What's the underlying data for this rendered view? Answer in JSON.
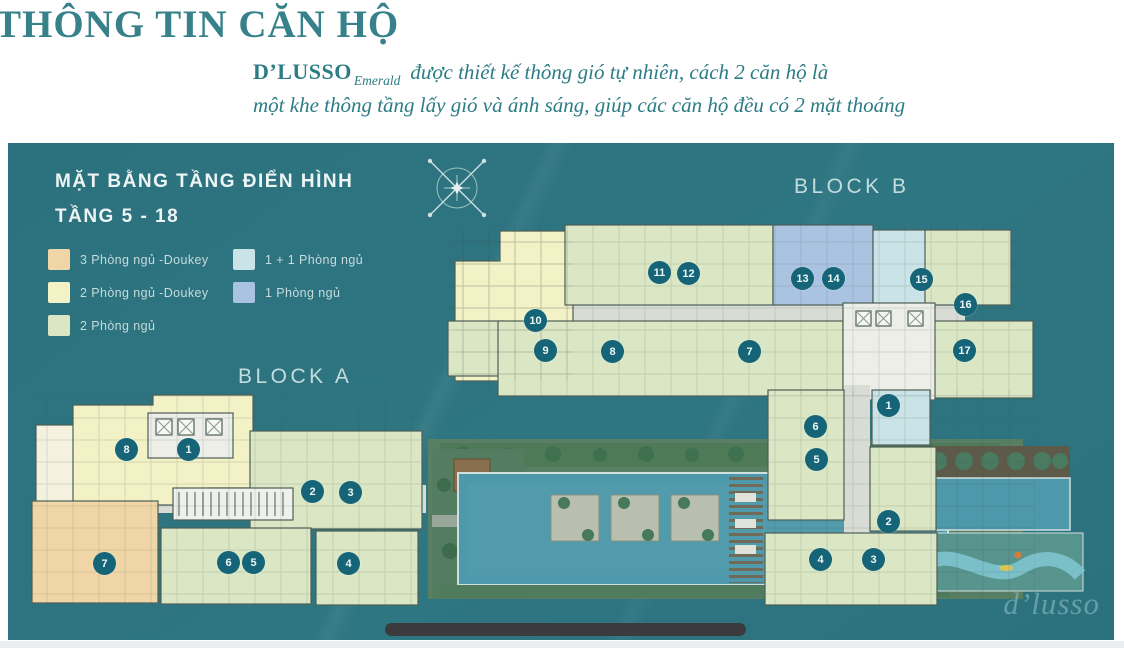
{
  "page": {
    "title": "THÔNG TIN CĂN HỘ",
    "intro": {
      "brand": "D’LUSSO",
      "brand_sub": "Emerald",
      "line1_rest": "được thiết kế thông gió tự nhiên, cách 2 căn hộ là",
      "line2": "một khe thông tầng lấy gió và ánh sáng, giúp các căn hộ đều có 2 mặt thoáng"
    },
    "colors": {
      "title": "#37818a",
      "intro_text": "#2c7c85"
    }
  },
  "panel": {
    "heading": "MẶT BẰNG TẦNG ĐIỂN HÌNH",
    "subheading": "TẦNG 5 - 18",
    "background": "#2d7380",
    "badge_color": "#166477",
    "watermark": "d’lusso",
    "compass_icon": "compass-rose-icon",
    "legend": {
      "items": [
        {
          "label": "3 Phòng ngủ -Doukey",
          "color": "#f0d6a7"
        },
        {
          "label": "2 Phòng ngủ -Doukey",
          "color": "#f3f1c6"
        },
        {
          "label": "2 Phòng ngủ",
          "color": "#dbe7c4"
        },
        {
          "label": "1 + 1 Phòng ngủ",
          "color": "#c9e3e6"
        },
        {
          "label": "1 Phòng ngủ",
          "color": "#aac3e1"
        }
      ]
    },
    "blocks": [
      {
        "label": "BLOCK A"
      },
      {
        "label": "BLOCK B"
      }
    ],
    "units": {
      "block_a": [
        {
          "no": "8",
          "type": 1,
          "x": 118,
          "y": 306
        },
        {
          "no": "1",
          "type": 1,
          "x": 180,
          "y": 306
        },
        {
          "no": "2",
          "type": 2,
          "x": 304,
          "y": 348
        },
        {
          "no": "3",
          "type": 2,
          "x": 342,
          "y": 349
        },
        {
          "no": "7",
          "type": 0,
          "x": 96,
          "y": 420
        },
        {
          "no": "6",
          "type": 2,
          "x": 220,
          "y": 419
        },
        {
          "no": "5",
          "type": 2,
          "x": 245,
          "y": 419
        },
        {
          "no": "4",
          "type": 2,
          "x": 340,
          "y": 420
        }
      ],
      "block_b": [
        {
          "no": "10",
          "type": 1,
          "x": 527,
          "y": 177
        },
        {
          "no": "11",
          "type": 2,
          "x": 651,
          "y": 129
        },
        {
          "no": "12",
          "type": 2,
          "x": 680,
          "y": 130
        },
        {
          "no": "13",
          "type": 4,
          "x": 794,
          "y": 135
        },
        {
          "no": "14",
          "type": 4,
          "x": 825,
          "y": 135
        },
        {
          "no": "15",
          "type": 3,
          "x": 913,
          "y": 136
        },
        {
          "no": "16",
          "type": 2,
          "x": 957,
          "y": 161
        },
        {
          "no": "9",
          "type": 2,
          "x": 537,
          "y": 207
        },
        {
          "no": "8",
          "type": 2,
          "x": 604,
          "y": 208
        },
        {
          "no": "7",
          "type": 2,
          "x": 741,
          "y": 208
        },
        {
          "no": "17",
          "type": 2,
          "x": 956,
          "y": 207
        },
        {
          "no": "1",
          "type": 3,
          "x": 880,
          "y": 262
        },
        {
          "no": "6",
          "type": 2,
          "x": 807,
          "y": 283
        },
        {
          "no": "5",
          "type": 2,
          "x": 808,
          "y": 316
        },
        {
          "no": "2",
          "type": 2,
          "x": 880,
          "y": 378
        },
        {
          "no": "4",
          "type": 2,
          "x": 812,
          "y": 416
        },
        {
          "no": "3",
          "type": 2,
          "x": 865,
          "y": 416
        }
      ]
    }
  }
}
